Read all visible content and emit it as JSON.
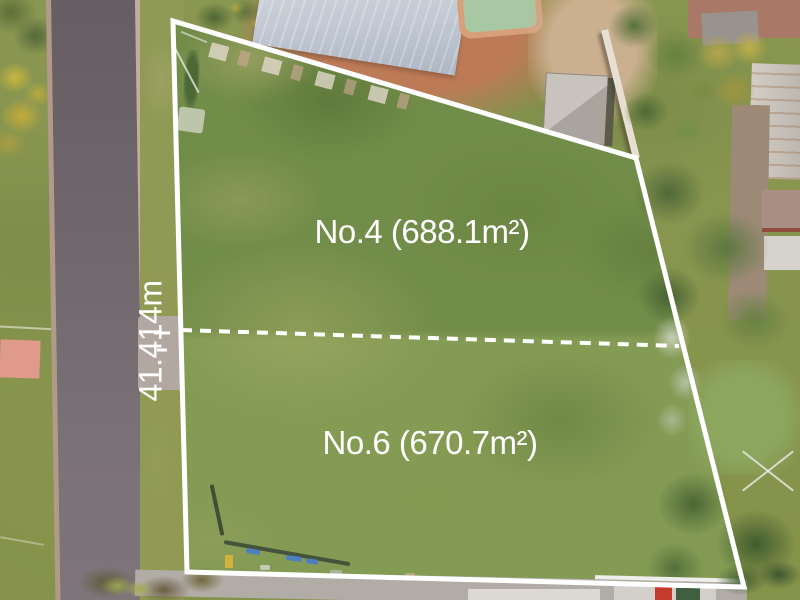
{
  "annotations": {
    "lot_top_label": "No.4 (688.1m²)",
    "lot_bottom_label": "No.6 (670.7m²)",
    "frontage_label": "41.414m"
  },
  "overlay": {
    "boundary_color": "#ffffff",
    "boundary_points": "173,21 636,158 744,587 187,572",
    "divider_style": "dashed"
  },
  "palette": {
    "grass": "#7c974f",
    "road_asphalt": "#6e666b",
    "kerb": "#b29a8b",
    "house_roof": "#c2c9d4",
    "pool_water": "#a8c8a3",
    "red_dirt": "#bd7a57",
    "annotation_text": "#ffffff"
  }
}
